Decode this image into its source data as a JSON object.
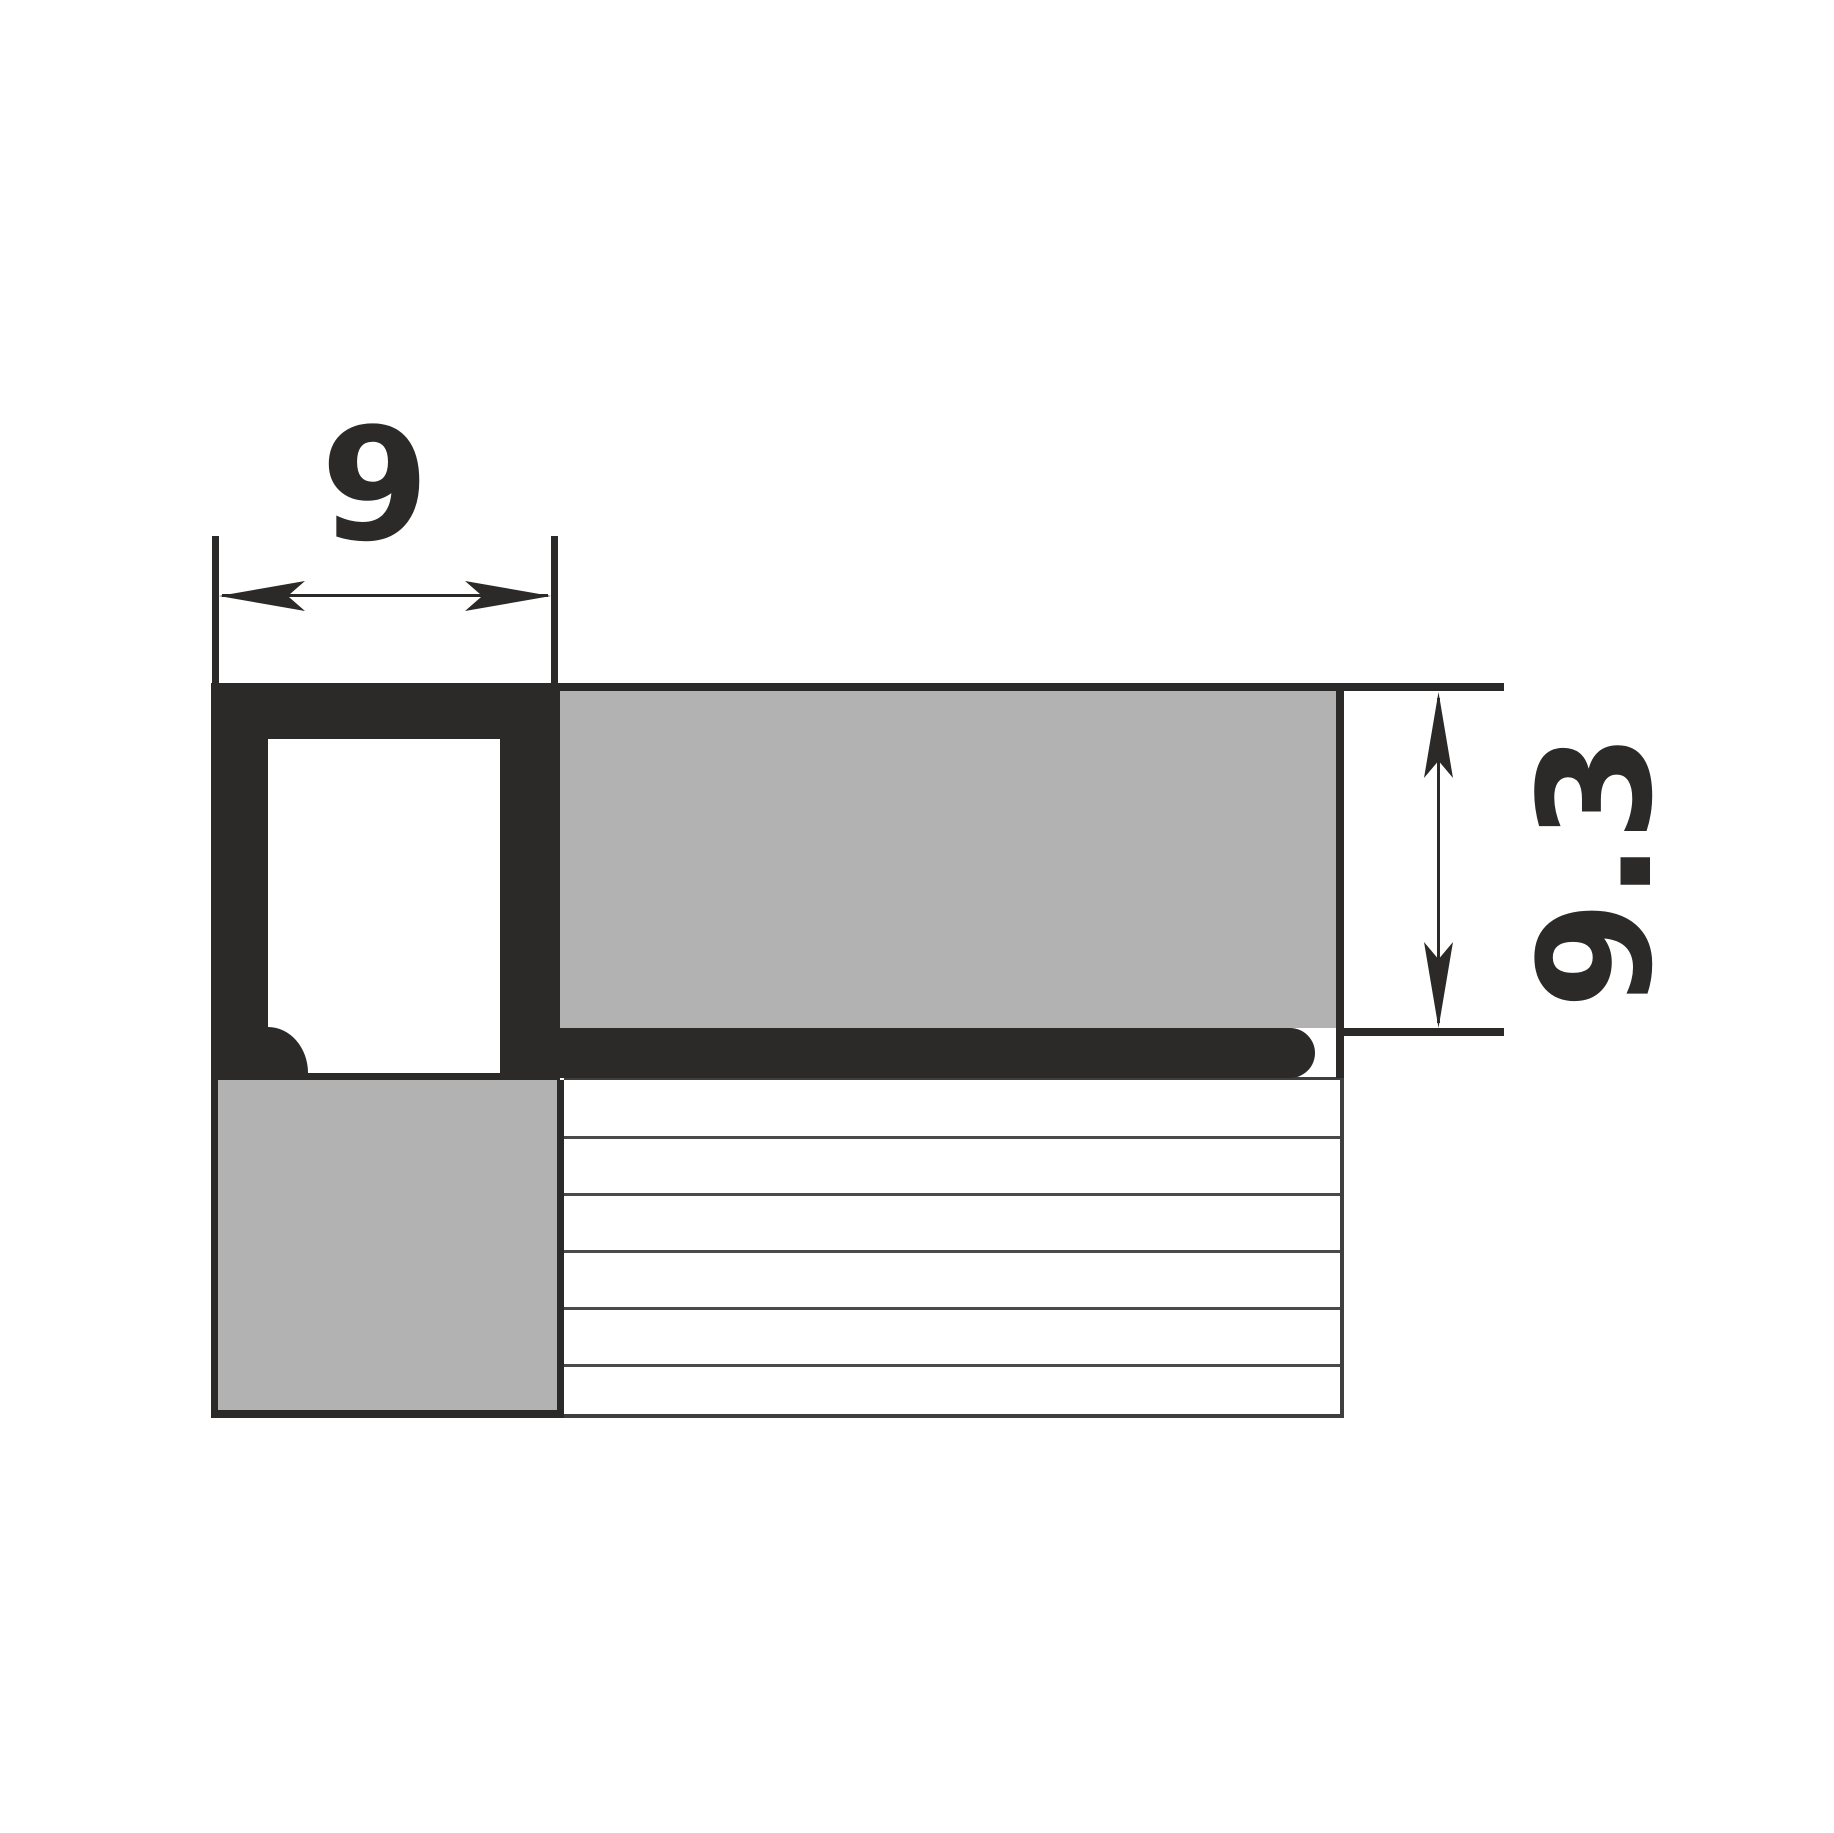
{
  "diagram": {
    "type": "technical-cross-section",
    "subject": "square-edge tile trim profile with tile and adhesive bed",
    "dimensions": {
      "width": {
        "value": "9"
      },
      "height": {
        "value": "9.3"
      }
    },
    "colors": {
      "ink": "#2B2A29",
      "tile_gray": "#B2B2B2",
      "rule_line": "#4A4A4A",
      "background": "#FFFFFF"
    }
  }
}
